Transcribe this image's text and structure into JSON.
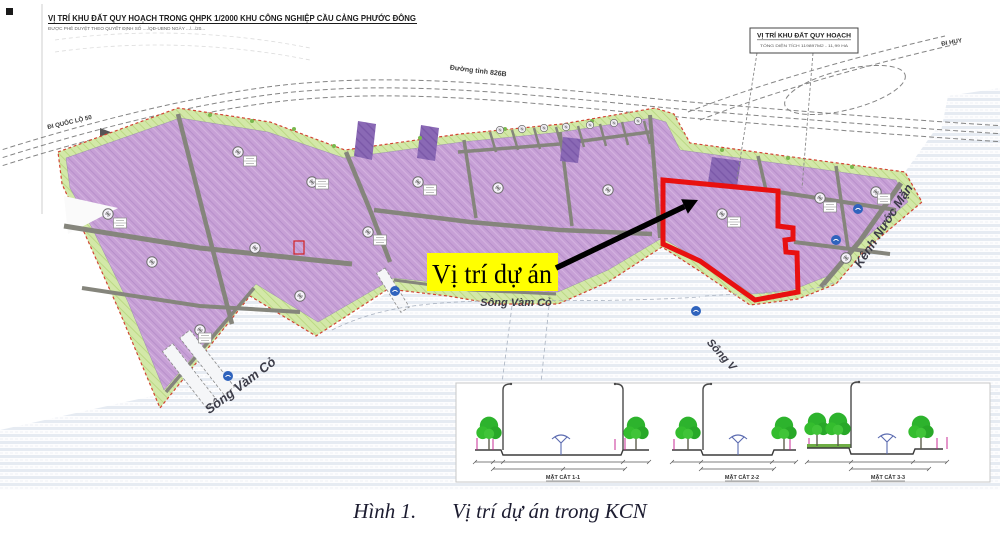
{
  "figure": {
    "caption_label": "Hình 1.",
    "caption_title": "Vị trí dự án trong KCN"
  },
  "map": {
    "header": {
      "title": "VỊ TRÍ KHU ĐẤT QUY HOẠCH TRONG QHPK 1/2000 KHU CÔNG NGHIỆP CẦU CẢNG PHƯỚC ĐÔNG",
      "subtitle": "ĐƯỢC PHÊ DUYỆT THEO QUYẾT ĐỊNH SỐ ..../QĐ-UBND NGÀY .../.../20..."
    },
    "legend_box": {
      "title": "VỊ TRÍ KHU ĐẤT QUY HOẠCH",
      "subtitle": "TỔNG DIỆN TÍCH 119897M2 - 11,99 HA"
    },
    "callout": {
      "label": "Vị trí dự án"
    },
    "labels": {
      "river_center": "Sông Vàm Cỏ",
      "river_left": "Sông Vàm Cỏ",
      "river_right": "Sông V",
      "canal": "Kênh Nước Mặn",
      "road_provincial": "Đường tỉnh 826B",
      "exit_west": "ĐI QUỐC LỘ 50",
      "exit_east": "ĐI HUY"
    },
    "cross_sections": [
      {
        "caption": "MẶT CẮT 1-1"
      },
      {
        "caption": "MẶT CẮT 2-2"
      },
      {
        "caption": "MẶT CẮT 3-3"
      }
    ],
    "colors": {
      "parcel": "#c7a0d6",
      "parcel_dark": "#8a69b5",
      "green_buffer": "#d3e8a8",
      "project_outline": "#e81010",
      "callout_highlight": "#ffff00",
      "water_stripe": "#e6ebf2",
      "road": "#85857c",
      "arrow": "#000000"
    }
  }
}
